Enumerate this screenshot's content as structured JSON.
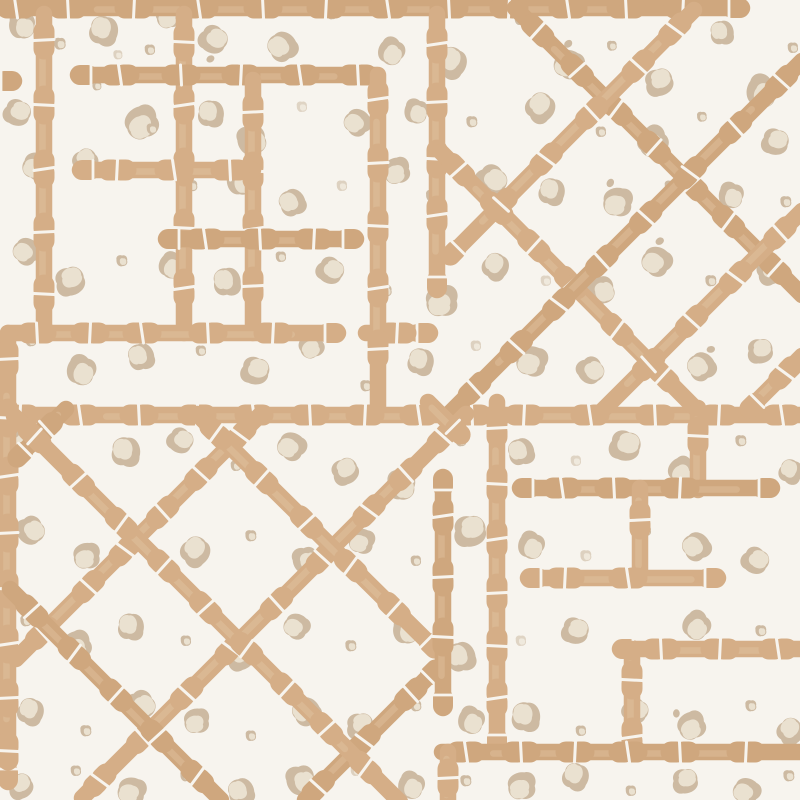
{
  "canvas": {
    "width": 800,
    "height": 800
  },
  "palette": {
    "background": "#f7f4ee",
    "bamboo": "#d5ae87",
    "bamboo_alt": "#cfa77e",
    "bamboo_wash": "#e6cba8",
    "spot_dark": "#cdbaa2",
    "spot_light": "#eae1d0"
  },
  "pattern": {
    "type": "bamboo-trellis-with-leopard-spots",
    "bar_width": 16.5,
    "node_gap_width": 3,
    "node_spacing": 52,
    "bars": [
      [
        -8,
        8,
        742,
        8,
        0,
        1
      ],
      [
        44,
        14,
        44,
        333,
        0,
        0
      ],
      [
        184,
        14,
        184,
        333,
        0,
        0
      ],
      [
        78,
        75,
        376,
        75,
        1,
        0
      ],
      [
        253,
        80,
        253,
        333,
        0,
        0
      ],
      [
        80,
        170,
        253,
        170,
        1,
        0
      ],
      [
        166,
        239,
        356,
        239,
        1,
        1
      ],
      [
        8,
        333,
        338,
        333,
        0,
        1
      ],
      [
        366,
        333,
        430,
        333,
        0,
        1
      ],
      [
        378,
        75,
        378,
        410,
        0,
        0
      ],
      [
        0,
        81,
        14,
        81,
        0,
        1
      ],
      [
        -8,
        415,
        808,
        415,
        0,
        0
      ],
      [
        437,
        14,
        437,
        290,
        0,
        1
      ],
      [
        515,
        8,
        802,
        295,
        0,
        0
      ],
      [
        441,
        152,
        696,
        409,
        0,
        0
      ],
      [
        694,
        10,
        449,
        257,
        0,
        1
      ],
      [
        802,
        61,
        450,
        413,
        0,
        0
      ],
      [
        802,
        211,
        600,
        413,
        0,
        0
      ],
      [
        802,
        356,
        748,
        410,
        0,
        1
      ],
      [
        8,
        333,
        8,
        782,
        0,
        1
      ],
      [
        66,
        409,
        16,
        459,
        0,
        1
      ],
      [
        261,
        414,
        16,
        659,
        0,
        0
      ],
      [
        466,
        414,
        82,
        798,
        0,
        0
      ],
      [
        437,
        668,
        305,
        800,
        1,
        0
      ],
      [
        197,
        414,
        436,
        650,
        0,
        1
      ],
      [
        14,
        416,
        400,
        802,
        0,
        0
      ],
      [
        10,
        589,
        221,
        800,
        0,
        0
      ],
      [
        428,
        402,
        462,
        436,
        0,
        1
      ],
      [
        497,
        402,
        497,
        748,
        0,
        1
      ],
      [
        698,
        408,
        698,
        490,
        0,
        0
      ],
      [
        520,
        488,
        772,
        488,
        1,
        1
      ],
      [
        640,
        488,
        640,
        578,
        0,
        0
      ],
      [
        528,
        578,
        718,
        578,
        1,
        1
      ],
      [
        443,
        477,
        443,
        708,
        1,
        1
      ],
      [
        620,
        649,
        808,
        649,
        1,
        0
      ],
      [
        632,
        649,
        632,
        752,
        0,
        0
      ],
      [
        442,
        752,
        808,
        752,
        0,
        0
      ],
      [
        448,
        752,
        448,
        802,
        0,
        0
      ]
    ],
    "spots": [
      [
        22,
        26,
        0,
        1.0,
        10,
        1
      ],
      [
        60,
        44,
        1,
        0.9,
        0,
        1
      ],
      [
        104,
        30,
        0,
        1.1,
        200,
        1
      ],
      [
        168,
        16,
        0,
        0.95,
        80,
        1
      ],
      [
        214,
        40,
        2,
        1.05,
        310,
        1
      ],
      [
        150,
        50,
        1,
        0.8,
        0,
        1
      ],
      [
        118,
        55,
        1,
        0.7,
        0,
        0.6
      ],
      [
        282,
        46,
        0,
        1.1,
        150,
        1
      ],
      [
        332,
        14,
        1,
        0.85,
        0,
        1
      ],
      [
        391,
        52,
        0,
        1.0,
        40,
        1
      ],
      [
        452,
        62,
        0,
        1.15,
        220,
        1
      ],
      [
        520,
        20,
        1,
        0.8,
        0,
        1
      ],
      [
        568,
        64,
        2,
        1.1,
        120,
        1
      ],
      [
        612,
        46,
        1,
        0.75,
        0,
        1
      ],
      [
        660,
        82,
        0,
        1.05,
        260,
        1
      ],
      [
        722,
        32,
        0,
        0.9,
        180,
        1
      ],
      [
        762,
        92,
        0,
        1.2,
        30,
        1
      ],
      [
        793,
        48,
        1,
        0.8,
        0,
        1
      ],
      [
        18,
        113,
        0,
        1.0,
        300,
        1
      ],
      [
        46,
        82,
        1,
        0.85,
        0,
        1
      ],
      [
        97,
        86,
        1,
        0.7,
        0,
        1
      ],
      [
        141,
        123,
        0,
        1.25,
        70,
        1
      ],
      [
        211,
        113,
        0,
        1.0,
        190,
        1
      ],
      [
        252,
        141,
        0,
        1.1,
        350,
        1
      ],
      [
        302,
        107,
        1,
        0.8,
        0,
        0.55
      ],
      [
        357,
        122,
        0,
        1.0,
        140,
        1
      ],
      [
        416,
        112,
        0,
        0.9,
        20,
        1
      ],
      [
        472,
        122,
        1,
        0.85,
        0,
        1
      ],
      [
        541,
        107,
        0,
        1.1,
        230,
        1
      ],
      [
        601,
        132,
        1,
        0.8,
        0,
        1
      ],
      [
        652,
        142,
        2,
        1.15,
        60,
        1
      ],
      [
        702,
        117,
        1,
        0.75,
        0,
        1
      ],
      [
        776,
        142,
        0,
        1.0,
        290,
        1
      ],
      [
        36,
        166,
        0,
        1.05,
        120,
        1
      ],
      [
        86,
        161,
        0,
        0.95,
        240,
        1
      ],
      [
        152,
        129,
        1,
        0.8,
        0,
        1
      ],
      [
        192,
        186,
        1,
        0.85,
        0,
        1
      ],
      [
        241,
        181,
        0,
        1.1,
        10,
        1
      ],
      [
        292,
        202,
        0,
        1.0,
        160,
        1
      ],
      [
        342,
        186,
        1,
        0.8,
        0,
        0.6
      ],
      [
        396,
        171,
        0,
        1.0,
        80,
        1
      ],
      [
        432,
        196,
        1,
        0.9,
        0,
        1
      ],
      [
        492,
        181,
        0,
        1.15,
        320,
        1
      ],
      [
        552,
        191,
        0,
        1.0,
        200,
        1
      ],
      [
        617,
        202,
        2,
        1.1,
        100,
        1
      ],
      [
        670,
        186,
        1,
        0.8,
        0,
        1
      ],
      [
        731,
        196,
        0,
        0.95,
        20,
        1
      ],
      [
        786,
        202,
        1,
        0.85,
        0,
        1
      ],
      [
        26,
        251,
        0,
        1.0,
        140,
        1
      ],
      [
        71,
        281,
        0,
        1.1,
        260,
        1
      ],
      [
        122,
        261,
        1,
        0.85,
        0,
        1
      ],
      [
        171,
        266,
        0,
        0.95,
        40,
        1
      ],
      [
        227,
        281,
        0,
        1.05,
        180,
        1
      ],
      [
        281,
        257,
        1,
        0.8,
        0,
        1
      ],
      [
        331,
        271,
        0,
        1.0,
        310,
        1
      ],
      [
        386,
        291,
        1,
        0.9,
        0,
        1
      ],
      [
        441,
        301,
        0,
        1.2,
        90,
        1
      ],
      [
        496,
        266,
        0,
        1.0,
        220,
        1
      ],
      [
        546,
        281,
        1,
        0.8,
        0,
        0.55
      ],
      [
        601,
        291,
        0,
        1.05,
        350,
        1
      ],
      [
        656,
        261,
        2,
        1.1,
        130,
        1
      ],
      [
        711,
        281,
        1,
        0.85,
        0,
        1
      ],
      [
        771,
        271,
        0,
        1.0,
        250,
        1
      ],
      [
        31,
        341,
        1,
        0.85,
        0,
        1
      ],
      [
        81,
        371,
        0,
        1.1,
        30,
        1
      ],
      [
        141,
        356,
        0,
        1.0,
        170,
        1
      ],
      [
        201,
        351,
        1,
        0.8,
        0,
        1
      ],
      [
        256,
        371,
        0,
        1.05,
        290,
        1
      ],
      [
        311,
        346,
        0,
        0.95,
        70,
        1
      ],
      [
        366,
        386,
        1,
        0.85,
        0,
        1
      ],
      [
        421,
        361,
        0,
        1.0,
        200,
        1
      ],
      [
        476,
        346,
        1,
        0.8,
        0,
        0.6
      ],
      [
        531,
        361,
        0,
        1.15,
        110,
        1
      ],
      [
        591,
        371,
        0,
        1.0,
        330,
        1
      ],
      [
        641,
        351,
        1,
        0.85,
        0,
        1
      ],
      [
        701,
        366,
        2,
        1.05,
        150,
        1
      ],
      [
        761,
        351,
        0,
        0.95,
        270,
        1
      ],
      [
        21,
        441,
        0,
        1.0,
        50,
        1
      ],
      [
        71,
        471,
        1,
        0.85,
        0,
        1
      ],
      [
        126,
        451,
        0,
        1.1,
        190,
        1
      ],
      [
        181,
        441,
        0,
        0.95,
        310,
        1
      ],
      [
        236,
        466,
        1,
        0.8,
        0,
        1
      ],
      [
        291,
        446,
        0,
        1.05,
        130,
        1
      ],
      [
        346,
        471,
        0,
        1.0,
        250,
        1
      ],
      [
        401,
        486,
        2,
        1.1,
        10,
        1
      ],
      [
        461,
        441,
        1,
        0.85,
        0,
        1
      ],
      [
        521,
        451,
        0,
        1.0,
        170,
        1
      ],
      [
        576,
        461,
        1,
        0.8,
        0,
        0.55
      ],
      [
        626,
        446,
        0,
        1.15,
        290,
        1
      ],
      [
        681,
        471,
        0,
        1.0,
        60,
        1
      ],
      [
        741,
        441,
        1,
        0.85,
        0,
        1
      ],
      [
        791,
        471,
        0,
        0.9,
        210,
        1
      ],
      [
        31,
        531,
        0,
        1.05,
        330,
        1
      ],
      [
        86,
        556,
        0,
        1.0,
        90,
        1
      ],
      [
        141,
        531,
        1,
        0.8,
        0,
        1
      ],
      [
        196,
        551,
        0,
        1.1,
        230,
        1
      ],
      [
        251,
        536,
        1,
        0.85,
        0,
        1
      ],
      [
        306,
        561,
        0,
        1.0,
        350,
        1
      ],
      [
        361,
        541,
        0,
        0.95,
        110,
        1
      ],
      [
        416,
        561,
        1,
        0.8,
        0,
        1
      ],
      [
        471,
        531,
        0,
        1.2,
        270,
        1
      ],
      [
        531,
        546,
        0,
        1.0,
        30,
        1
      ],
      [
        586,
        556,
        1,
        0.85,
        0,
        0.6
      ],
      [
        646,
        531,
        1,
        0.8,
        0,
        1
      ],
      [
        696,
        546,
        0,
        1.05,
        150,
        1
      ],
      [
        756,
        561,
        0,
        1.0,
        310,
        1
      ],
      [
        26,
        621,
        1,
        0.85,
        0,
        1
      ],
      [
        76,
        646,
        0,
        1.1,
        70,
        1
      ],
      [
        131,
        626,
        0,
        1.0,
        190,
        1
      ],
      [
        186,
        641,
        1,
        0.8,
        0,
        1
      ],
      [
        241,
        656,
        0,
        1.05,
        250,
        1
      ],
      [
        296,
        626,
        0,
        0.95,
        130,
        1
      ],
      [
        351,
        646,
        1,
        0.85,
        0,
        1
      ],
      [
        406,
        631,
        0,
        1.0,
        10,
        1
      ],
      [
        461,
        656,
        0,
        1.1,
        170,
        1
      ],
      [
        521,
        641,
        1,
        0.8,
        0,
        0.55
      ],
      [
        576,
        631,
        0,
        1.0,
        290,
        1
      ],
      [
        696,
        626,
        0,
        1.05,
        50,
        1
      ],
      [
        761,
        631,
        1,
        0.85,
        0,
        1
      ],
      [
        31,
        711,
        0,
        1.0,
        210,
        1
      ],
      [
        86,
        731,
        1,
        0.85,
        0,
        1
      ],
      [
        141,
        706,
        0,
        1.1,
        330,
        1
      ],
      [
        196,
        721,
        0,
        0.95,
        90,
        1
      ],
      [
        251,
        736,
        1,
        0.8,
        0,
        1
      ],
      [
        306,
        711,
        0,
        1.05,
        150,
        1
      ],
      [
        361,
        726,
        0,
        1.0,
        270,
        1
      ],
      [
        416,
        706,
        1,
        0.85,
        0,
        1
      ],
      [
        471,
        721,
        0,
        1.0,
        30,
        1
      ],
      [
        526,
        716,
        0,
        1.1,
        190,
        1
      ],
      [
        581,
        731,
        1,
        0.8,
        0,
        1
      ],
      [
        636,
        711,
        0,
        0.95,
        310,
        1
      ],
      [
        691,
        726,
        2,
        1.05,
        70,
        1
      ],
      [
        751,
        706,
        1,
        0.85,
        0,
        1
      ],
      [
        791,
        731,
        0,
        1.0,
        230,
        1
      ],
      [
        21,
        786,
        0,
        0.95,
        250,
        1
      ],
      [
        76,
        771,
        1,
        0.8,
        0,
        1
      ],
      [
        131,
        791,
        0,
        1.05,
        110,
        1
      ],
      [
        186,
        776,
        1,
        0.85,
        0,
        1
      ],
      [
        241,
        791,
        0,
        1.0,
        170,
        1
      ],
      [
        301,
        781,
        0,
        1.1,
        350,
        1
      ],
      [
        356,
        771,
        1,
        0.8,
        0,
        0.6
      ],
      [
        411,
        786,
        0,
        1.0,
        30,
        1
      ],
      [
        466,
        781,
        1,
        0.85,
        0,
        1
      ],
      [
        521,
        786,
        0,
        1.05,
        90,
        1
      ],
      [
        576,
        776,
        0,
        1.0,
        210,
        1
      ],
      [
        631,
        791,
        1,
        0.8,
        0,
        1
      ],
      [
        686,
        781,
        0,
        0.95,
        270,
        1
      ],
      [
        746,
        791,
        0,
        1.0,
        130,
        1
      ],
      [
        789,
        776,
        1,
        0.85,
        0,
        1
      ]
    ]
  }
}
